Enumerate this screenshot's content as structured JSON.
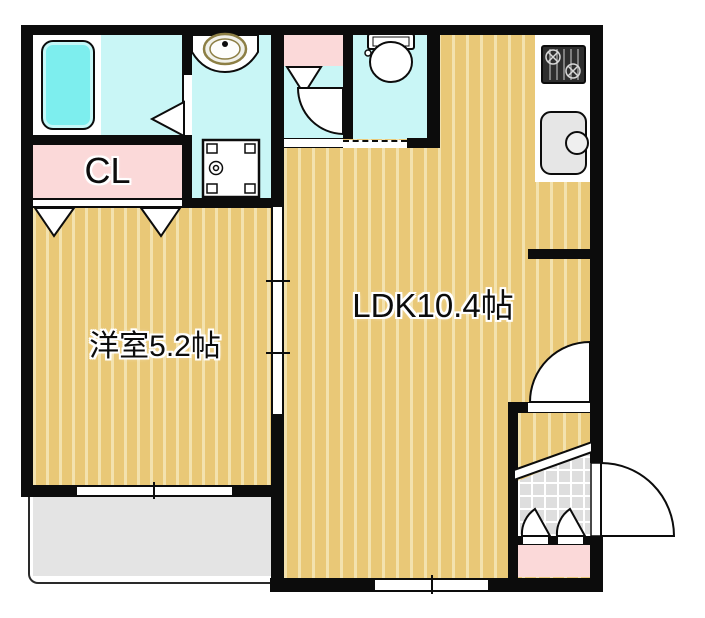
{
  "floor_plan": {
    "type": "japanese-apartment-floor-plan",
    "rooms": {
      "closet": {
        "label": "CL"
      },
      "western_room": {
        "label": "洋室5.2帖"
      },
      "ldk": {
        "label": "LDK10.4帖"
      }
    },
    "fixtures": [
      "bathtub",
      "vanity-sink",
      "washing-machine-pan",
      "toilet",
      "gas-stove",
      "kitchen-sink",
      "balcony",
      "entrance-door",
      "interior-swing-doors",
      "sliding-door",
      "closet-folding-doors",
      "shoe-cabinet-doors",
      "sliding-windows",
      "genkan-tile-step"
    ],
    "colors": {
      "wall": "#0c0c0c",
      "wood_floor": "#e9c877",
      "wood_stripe": "#f3e2ae",
      "wet_area": "#c9f6f6",
      "bathtub": "#7deeee",
      "storage_pink": "#fbd9d9",
      "balcony_gray": "#e4e4e4",
      "tile_gray": "#dedede",
      "label_text": "#0c0c0c",
      "label_halo": "#ffffff"
    }
  }
}
